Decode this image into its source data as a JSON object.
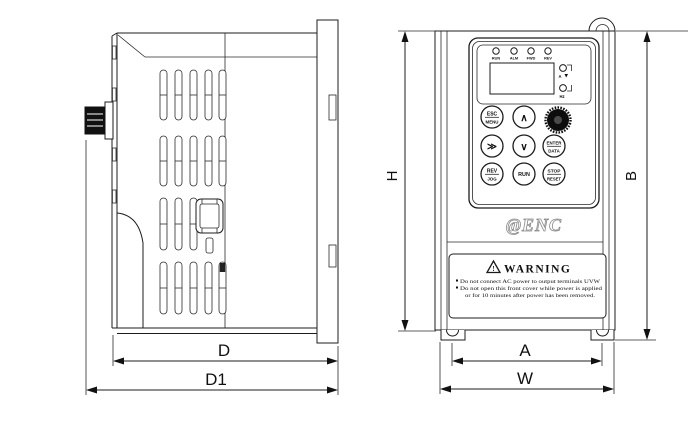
{
  "figure": {
    "dimensions": {
      "D": "D",
      "D1": "D1",
      "H": "H",
      "B": "B",
      "A": "A",
      "W": "W"
    },
    "keypad": {
      "status_leds": [
        "RUN",
        "ALM",
        "FWD",
        "REV"
      ],
      "unit_leds": [
        "A",
        "Hz"
      ],
      "buttons": {
        "esc_menu": {
          "top": "ESC",
          "bottom": "MENU"
        },
        "up": "∧",
        "down": "∨",
        "shift": "≫",
        "enter_data": {
          "top": "ENTER",
          "bottom": "DATA"
        },
        "rev_jog": {
          "top": "REV",
          "bottom": "JOG"
        },
        "run": "RUN",
        "stop_reset": {
          "top": "STOP",
          "bottom": "RESET"
        }
      }
    },
    "brand_logo": "@ENC",
    "warning_label": {
      "title": "WARNING",
      "lines": [
        "Do not connect AC power to output terminals UVW",
        "Do not open this front cover while power is applied",
        "or for 10 minutes after power has been removed."
      ]
    }
  }
}
